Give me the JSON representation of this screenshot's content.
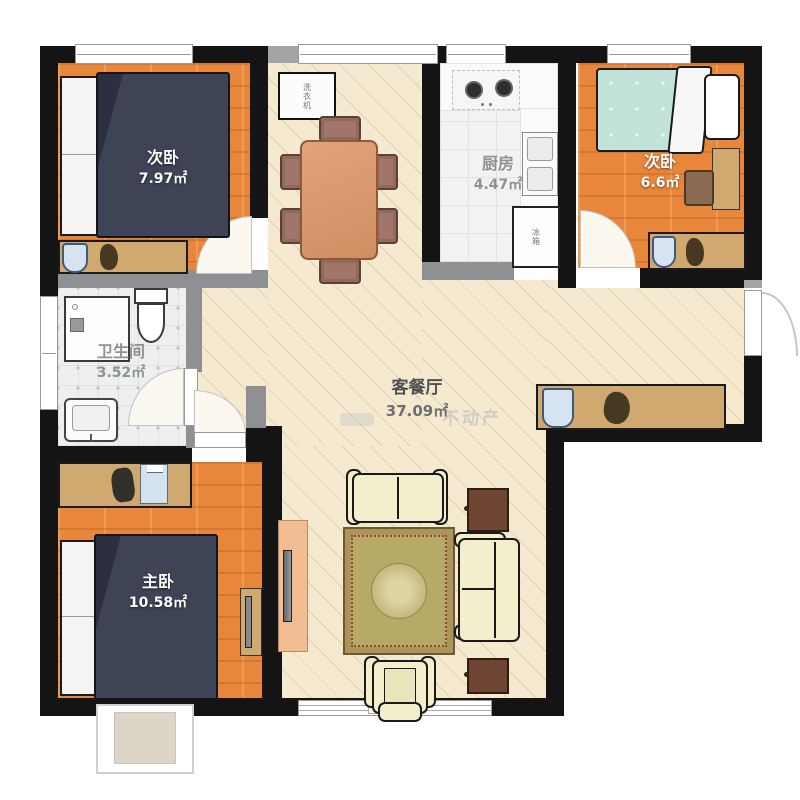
{
  "floor_plan": {
    "rooms": [
      {
        "key": "bedroom-top-left",
        "name": "次卧",
        "area": "7.97㎡"
      },
      {
        "key": "kitchen",
        "name": "厨房",
        "area": "4.47㎡"
      },
      {
        "key": "bedroom-top-right",
        "name": "次卧",
        "area": "6.6㎡"
      },
      {
        "key": "bathroom",
        "name": "卫生间",
        "area": "3.52㎡"
      },
      {
        "key": "living-dining",
        "name": "客餐厅",
        "area": "37.09㎡"
      },
      {
        "key": "master-bedroom",
        "name": "主卧",
        "area": "10.58㎡"
      }
    ],
    "appliances": {
      "washing_machine": "洗衣机",
      "fridge": "冰箱"
    },
    "watermark": {
      "text": "不动产"
    },
    "colors": {
      "wall": "#141414",
      "wall_light": "#8f9094",
      "wood_floor": "#e8873b",
      "living_floor": "#f5ead0",
      "kitchen_tile": "#f2f2f1",
      "bath_tile": "#eef0f0",
      "bed_navy": "#3e4356",
      "bed_teal": "#c2e2da",
      "sofa_cream": "#f3efcd",
      "rug_gold": "#ab9558",
      "furniture_tan": "#cfa96f",
      "dining_table": "#dc9a6e",
      "side_table_brown": "#6e4433",
      "chair_blue": "#d6e4f2",
      "tv_cabinet_peach": "#f2bd93"
    }
  }
}
